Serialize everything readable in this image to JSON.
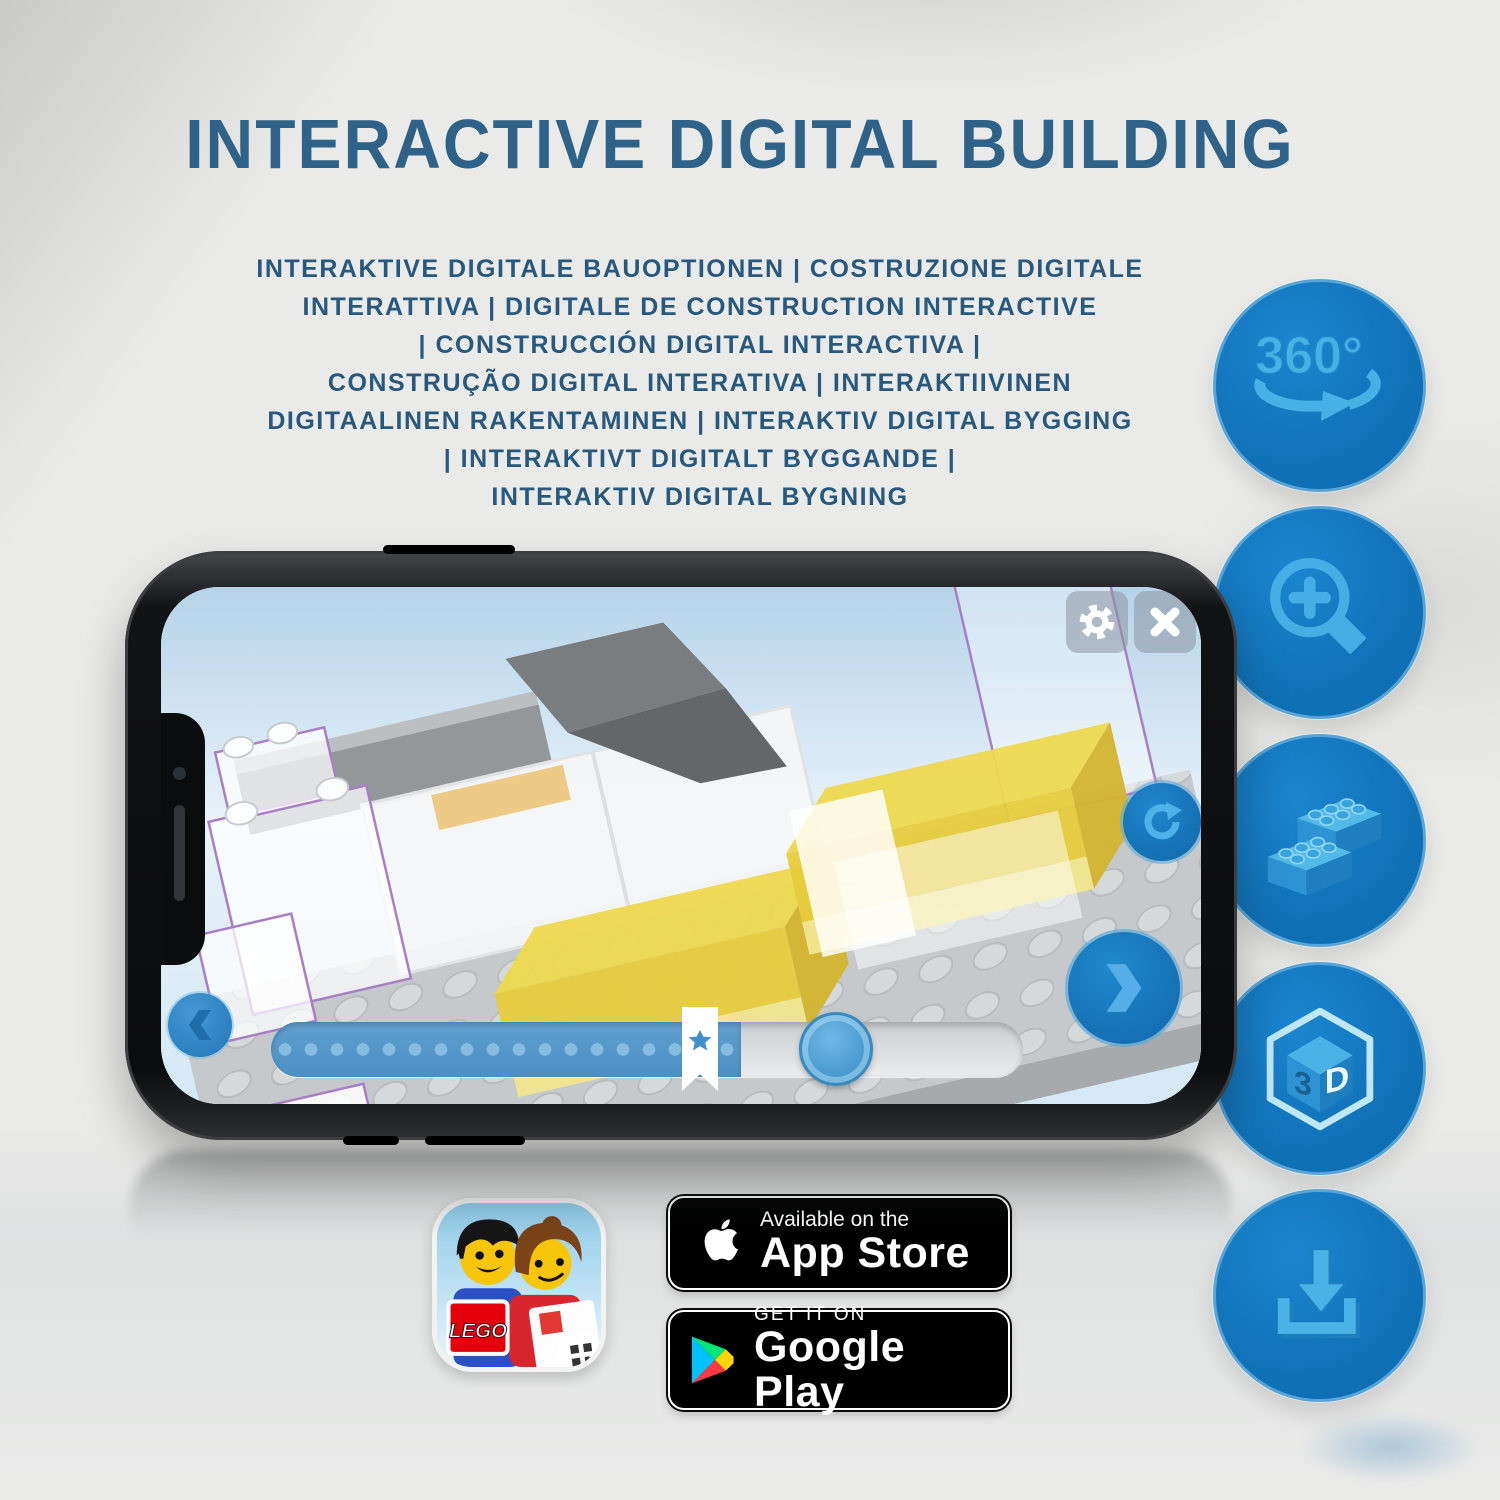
{
  "header": {
    "title": "INTERACTIVE DIGITAL BUILDING"
  },
  "subtitle": {
    "lines": [
      "INTERAKTIVE DIGITALE BAUOPTIONEN | COSTRUZIONE DIGITALE",
      "INTERATTIVA | DIGITALE DE CONSTRUCTION INTERACTIVE",
      "| CONSTRUCCIÓN DIGITAL INTERACTIVA |",
      "CONSTRUÇÃO DIGITAL INTERATIVA | INTERAKTIIVINEN",
      "DIGITAALINEN RAKENTAMINEN | INTERAKTIV DIGITAL BYGGING",
      "| INTERAKTIVT DIGITALT BYGGANDE |",
      "INTERAKTIV DIGITAL BYGNING"
    ]
  },
  "features": {
    "rotate_360_label": "360°",
    "cube_left": "3",
    "cube_right": "D"
  },
  "badges": {
    "app_store": {
      "tagline": "Available on the",
      "store": "App Store"
    },
    "google_play": {
      "tagline": "GET IT ON",
      "store": "Google Play"
    },
    "lego_logo": "LEGO"
  },
  "colors": {
    "title_blue": "#2e6288",
    "subtitle_blue": "#27587e",
    "feature_circle_blue": "#1478bf",
    "feature_icon_blue": "#46aee4",
    "app_accent_blue": "#2b87c6",
    "bed_yellow": "#edd84e",
    "badge_black": "#000000"
  }
}
